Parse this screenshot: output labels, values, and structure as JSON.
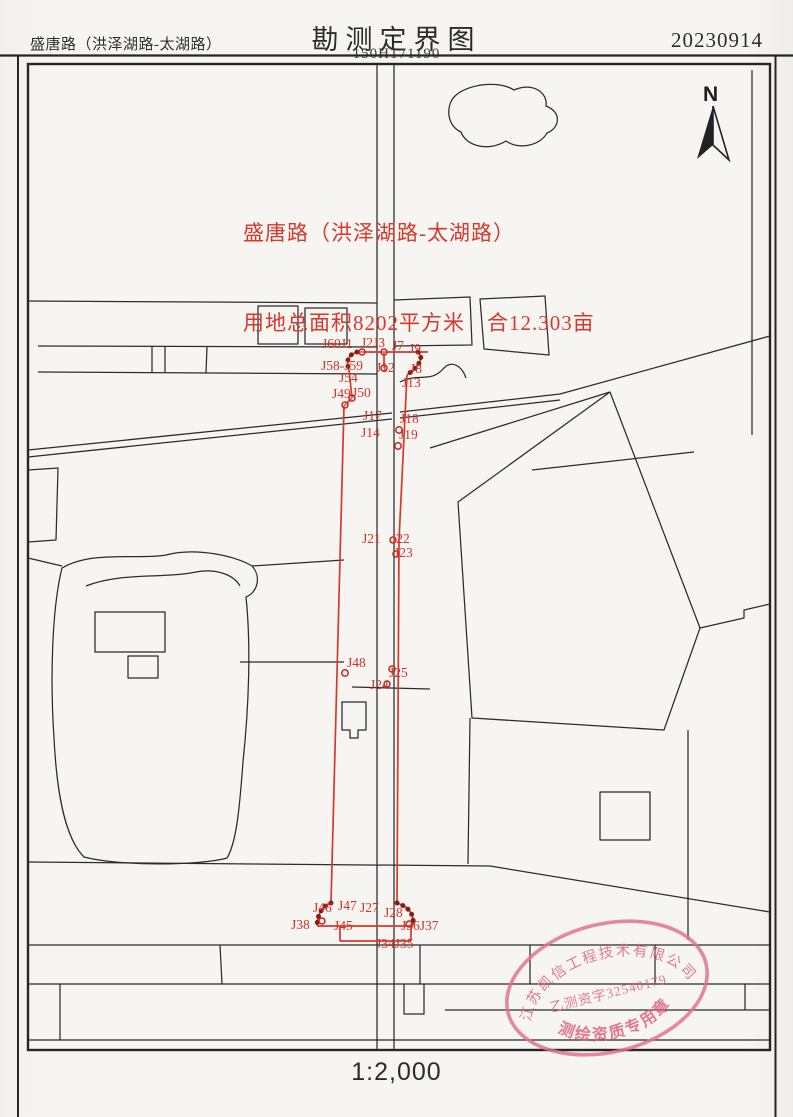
{
  "header": {
    "road_title": "盛唐路（洪泽湖路-太湖路）",
    "title": "勘测定界图",
    "sheet_no": "150H171190",
    "date": "20230914"
  },
  "annotation": {
    "line1": "盛唐路（洪泽湖路-太湖路）",
    "line2": "用地总面积8202平方米　合12.303亩"
  },
  "north": {
    "label": "N"
  },
  "scale": {
    "label": "1:2,000"
  },
  "stamp": {
    "company": "江苏凯信工程技术有限公司",
    "license": "乙测资字32540179",
    "caption": "测绘资质专用章"
  },
  "colors": {
    "boundary_red": "#d8382b",
    "point_chain_dark": "#7e150c",
    "linework_black": "#2b2b30",
    "stamp_pink": "#e2718a",
    "paper": "#f6f5f2"
  },
  "survey_points": [
    {
      "label": "J60J1",
      "x": 322,
      "y": 348
    },
    {
      "label": "J2J3",
      "x": 361,
      "y": 347
    },
    {
      "label": "J7",
      "x": 392,
      "y": 350
    },
    {
      "label": "J9",
      "x": 409,
      "y": 353
    },
    {
      "label": "J58-J59",
      "x": 321,
      "y": 370
    },
    {
      "label": "J12",
      "x": 376,
      "y": 372
    },
    {
      "label": "J8",
      "x": 410,
      "y": 373
    },
    {
      "label": "J54",
      "x": 339,
      "y": 382
    },
    {
      "label": "J13",
      "x": 402,
      "y": 387
    },
    {
      "label": "J49",
      "x": 332,
      "y": 398
    },
    {
      "label": "J50",
      "x": 352,
      "y": 397
    },
    {
      "label": "J17",
      "x": 363,
      "y": 420
    },
    {
      "label": "J18",
      "x": 400,
      "y": 423
    },
    {
      "label": "J14",
      "x": 361,
      "y": 437
    },
    {
      "label": "J19",
      "x": 399,
      "y": 439
    },
    {
      "label": "J21",
      "x": 362,
      "y": 543
    },
    {
      "label": "J22",
      "x": 391,
      "y": 543
    },
    {
      "label": "J23",
      "x": 394,
      "y": 557
    },
    {
      "label": "J48",
      "x": 347,
      "y": 667
    },
    {
      "label": "J25",
      "x": 389,
      "y": 677
    },
    {
      "label": "J24",
      "x": 370,
      "y": 689
    },
    {
      "label": "J46",
      "x": 313,
      "y": 912
    },
    {
      "label": "J47",
      "x": 338,
      "y": 910
    },
    {
      "label": "J27",
      "x": 360,
      "y": 912
    },
    {
      "label": "J28",
      "x": 384,
      "y": 917
    },
    {
      "label": "J38",
      "x": 291,
      "y": 929
    },
    {
      "label": "J45",
      "x": 334,
      "y": 930
    },
    {
      "label": "J36J37",
      "x": 401,
      "y": 930
    },
    {
      "label": "J34J35",
      "x": 376,
      "y": 948
    }
  ]
}
